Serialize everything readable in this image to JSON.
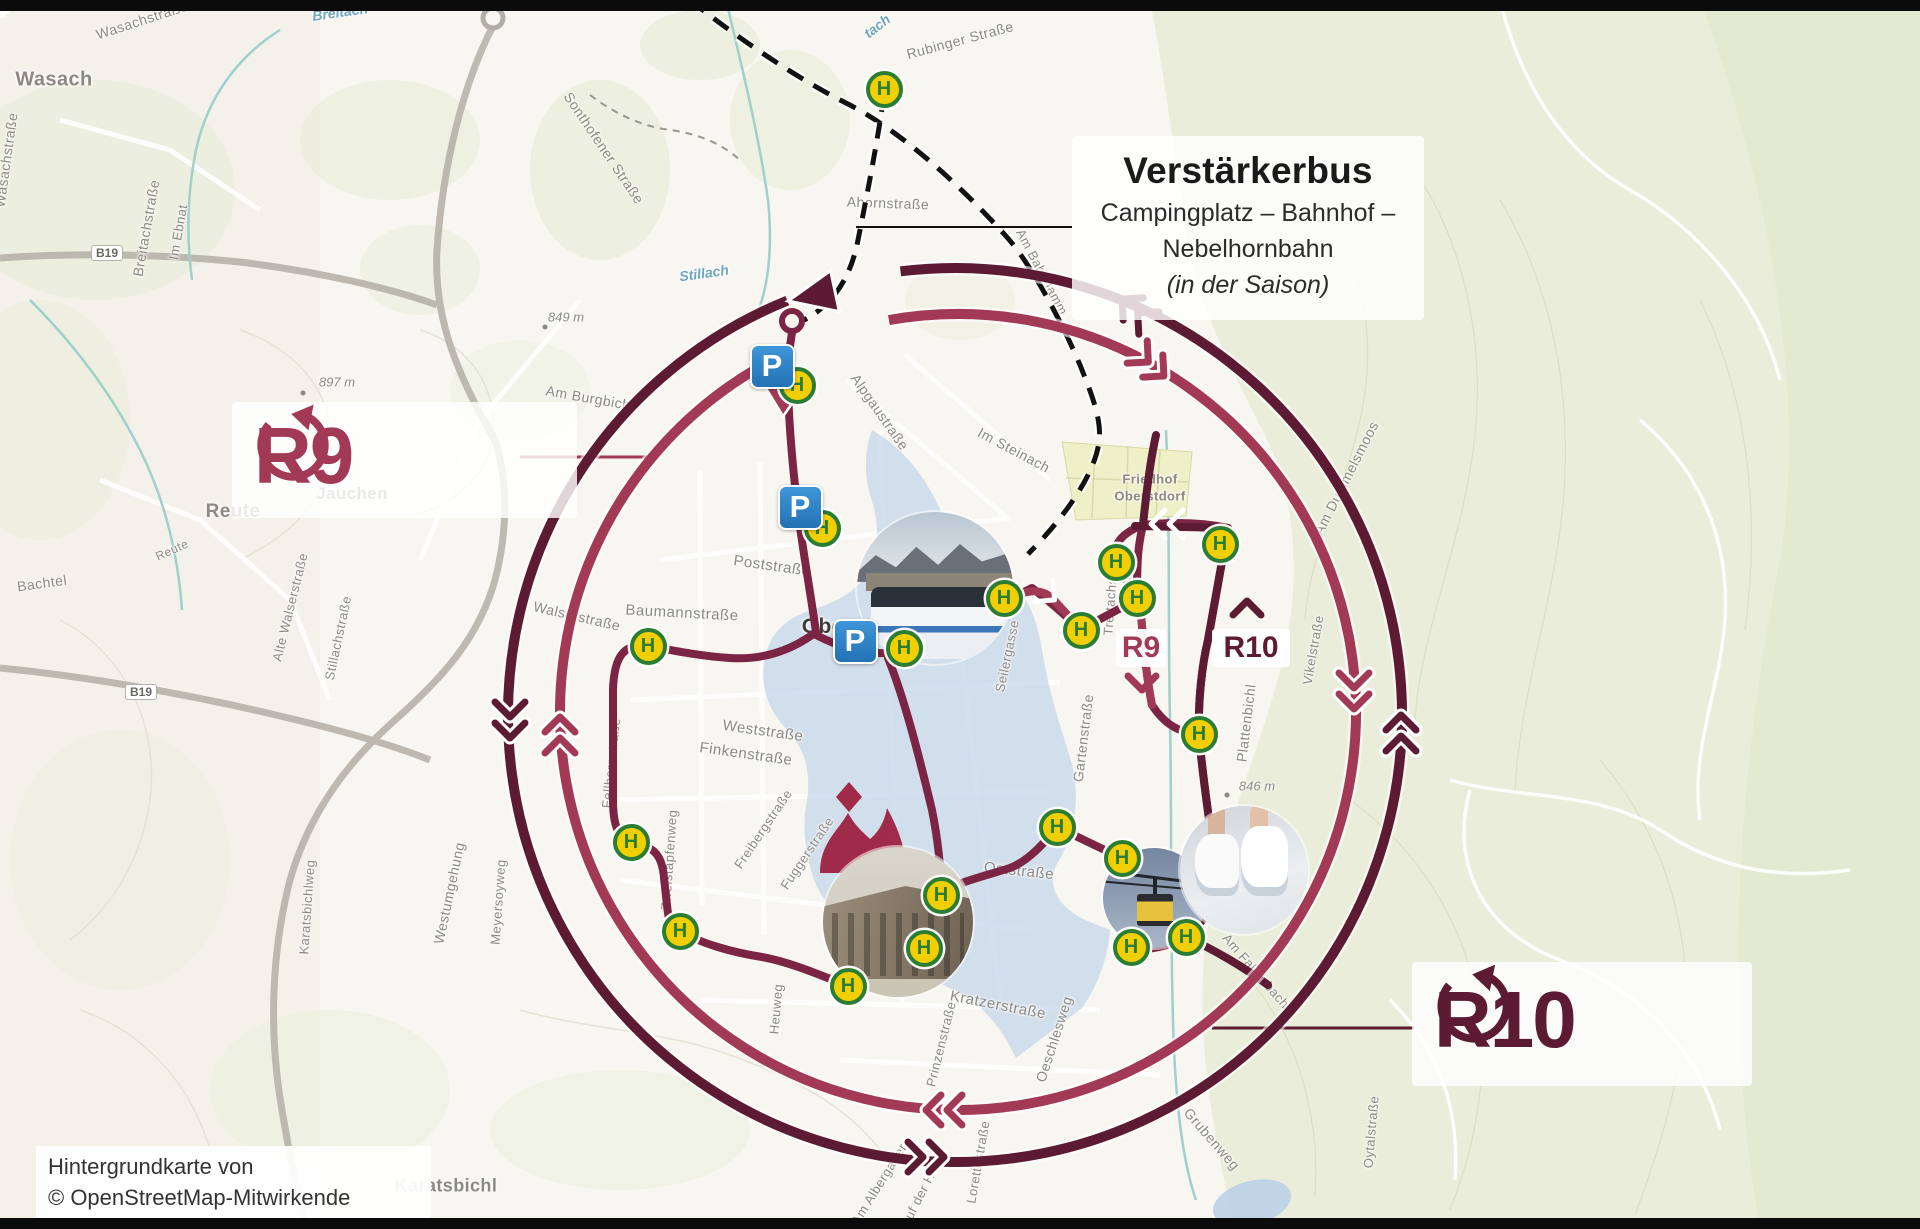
{
  "map": {
    "size": {
      "width": 1920,
      "height": 1229
    },
    "attribution": {
      "line1": "Hintergrundkarte von",
      "line2": "© OpenStreetMap-Mitwirkende"
    },
    "verstaerkerbus": {
      "title": "Verstärkerbus",
      "line1": "Campingplatz – Bahnhof –",
      "line2": "Nebelhornbahn",
      "line3": "(in der Saison)"
    },
    "route_labels": {
      "r9": "R9",
      "r10": "R10"
    },
    "inline_labels": {
      "r9": "R9",
      "r10": "R10"
    },
    "symbols": {
      "bus_stop": "H",
      "parking": "P"
    },
    "icons": {
      "r9_loop": "loop-arrow-counterclockwise",
      "r10_loop": "loop-arrow-counterclockwise"
    },
    "colors": {
      "r9": "#a23a56",
      "r10": "#5c1b33",
      "route": "#7b2444",
      "stopG": "#2a7d33",
      "stopY": "#f2cf00",
      "pblue": "#2f86c8",
      "water": "#b9cfe6",
      "forest": "#e9edda",
      "labelGray": "#8d8881",
      "ink": "#111111"
    },
    "road_badges": [
      {
        "t": "B19",
        "x": 107,
        "y": 253
      },
      {
        "t": "B19",
        "x": 141,
        "y": 692
      }
    ],
    "place_labels": [
      {
        "t": "Wasach",
        "x": 54,
        "y": 80,
        "s": 20
      },
      {
        "t": "Jauchen",
        "x": 352,
        "y": 494,
        "s": 17
      },
      {
        "t": "Reute",
        "x": 233,
        "y": 512,
        "s": 19
      },
      {
        "t": "Oberstdorf",
        "x": 858,
        "y": 627,
        "s": 21,
        "dark": true
      },
      {
        "t": "Friedhof",
        "x": 1150,
        "y": 479,
        "s": 13
      },
      {
        "t": "Oberstdorf",
        "x": 1150,
        "y": 496,
        "s": 13
      },
      {
        "t": "Karatsbichl",
        "x": 446,
        "y": 1186,
        "s": 18
      }
    ],
    "street_labels": [
      {
        "t": "Wasachstraße",
        "x": 142,
        "y": 20,
        "r": -18,
        "s": 14
      },
      {
        "t": "Wasachstraße",
        "x": 6,
        "y": 160,
        "r": -82,
        "s": 14
      },
      {
        "t": "Breitachstraße",
        "x": 146,
        "y": 228,
        "r": -80,
        "s": 14
      },
      {
        "t": "Im Ebnat",
        "x": 178,
        "y": 232,
        "r": -80,
        "s": 13
      },
      {
        "t": "Bachtel",
        "x": 42,
        "y": 583,
        "r": -8,
        "s": 14
      },
      {
        "t": "Sonthofener Straße",
        "x": 604,
        "y": 148,
        "r": 56,
        "s": 14
      },
      {
        "t": "Ahornstraße",
        "x": 888,
        "y": 203,
        "r": 2,
        "s": 14
      },
      {
        "t": "Rubinger Straße",
        "x": 960,
        "y": 40,
        "r": -15,
        "s": 14
      },
      {
        "t": "Am Bahndamm",
        "x": 1042,
        "y": 272,
        "r": 62,
        "s": 13
      },
      {
        "t": "Am Burgbichl",
        "x": 590,
        "y": 398,
        "r": 10,
        "s": 14
      },
      {
        "t": "Alpgaustraße",
        "x": 880,
        "y": 412,
        "r": 55,
        "s": 14
      },
      {
        "t": "Im Steinach",
        "x": 1014,
        "y": 450,
        "r": 28,
        "s": 14
      },
      {
        "t": "Am Dummelsmoos",
        "x": 1346,
        "y": 478,
        "r": -63,
        "s": 14
      },
      {
        "t": "Alte Walserstraße",
        "x": 290,
        "y": 607,
        "r": -76,
        "s": 13
      },
      {
        "t": "Stillachstraße",
        "x": 338,
        "y": 638,
        "r": -78,
        "s": 13
      },
      {
        "t": "Reute",
        "x": 172,
        "y": 550,
        "r": -24,
        "s": 12
      },
      {
        "t": "Walserstraße",
        "x": 577,
        "y": 616,
        "r": 13,
        "s": 14
      },
      {
        "t": "Baumannstraße",
        "x": 682,
        "y": 613,
        "r": 3,
        "s": 15
      },
      {
        "t": "Poststraße",
        "x": 772,
        "y": 566,
        "r": 8,
        "s": 15
      },
      {
        "t": "Weststraße",
        "x": 763,
        "y": 731,
        "r": 8,
        "s": 15
      },
      {
        "t": "Finkenstraße",
        "x": 746,
        "y": 754,
        "r": 8,
        "s": 15
      },
      {
        "t": "Fellhornstraße",
        "x": 611,
        "y": 763,
        "r": -84,
        "s": 13
      },
      {
        "t": "Freibergstraße",
        "x": 763,
        "y": 829,
        "r": -56,
        "s": 13
      },
      {
        "t": "Fuggerstraße",
        "x": 807,
        "y": 853,
        "r": -56,
        "s": 13
      },
      {
        "t": "Zweistapfenweg",
        "x": 669,
        "y": 860,
        "r": -86,
        "s": 13
      },
      {
        "t": "Westumgehung",
        "x": 449,
        "y": 893,
        "r": -78,
        "s": 14
      },
      {
        "t": "Meyersoyweg",
        "x": 498,
        "y": 902,
        "r": -86,
        "s": 13
      },
      {
        "t": "Karatsbichlweg",
        "x": 307,
        "y": 907,
        "r": -86,
        "s": 13
      },
      {
        "t": "Heuweg",
        "x": 776,
        "y": 1009,
        "r": -85,
        "s": 13
      },
      {
        "t": "Seilergasse",
        "x": 1007,
        "y": 656,
        "r": -78,
        "s": 13
      },
      {
        "t": "Trettachstraße",
        "x": 1111,
        "y": 590,
        "r": -86,
        "s": 13
      },
      {
        "t": "Gartenstraße",
        "x": 1083,
        "y": 738,
        "r": -83,
        "s": 14
      },
      {
        "t": "Plattenbichl",
        "x": 1246,
        "y": 723,
        "r": -83,
        "s": 14
      },
      {
        "t": "Vikelstraße",
        "x": 1313,
        "y": 650,
        "r": -80,
        "s": 13
      },
      {
        "t": "Oststraße",
        "x": 1019,
        "y": 871,
        "r": 6,
        "s": 15
      },
      {
        "t": "Kratzerstraße",
        "x": 998,
        "y": 1005,
        "r": 11,
        "s": 15
      },
      {
        "t": "Oeschlesweg",
        "x": 1054,
        "y": 1039,
        "r": -72,
        "s": 14
      },
      {
        "t": "Sachserweg",
        "x": 942,
        "y": 944,
        "r": -80,
        "s": 13
      },
      {
        "t": "Prinzenstraße",
        "x": 941,
        "y": 1044,
        "r": -76,
        "s": 13
      },
      {
        "t": "Lorettostraße",
        "x": 978,
        "y": 1162,
        "r": -80,
        "s": 13
      },
      {
        "t": "Am Albergatter",
        "x": 879,
        "y": 1184,
        "r": -58,
        "s": 13
      },
      {
        "t": "Auf der Höh",
        "x": 921,
        "y": 1193,
        "r": -63,
        "s": 13
      },
      {
        "t": "Grubenweg",
        "x": 1212,
        "y": 1139,
        "r": 49,
        "s": 14
      },
      {
        "t": "Oytalstraße",
        "x": 1371,
        "y": 1132,
        "r": -85,
        "s": 13
      },
      {
        "t": "Am Faltenbach",
        "x": 1256,
        "y": 971,
        "r": 49,
        "s": 13
      }
    ],
    "water_labels": [
      {
        "t": "Breitach",
        "x": 340,
        "y": 12,
        "r": -8
      },
      {
        "t": "tach",
        "x": 877,
        "y": 26,
        "r": -38
      },
      {
        "t": "Stillach",
        "x": 704,
        "y": 273,
        "r": -8
      }
    ],
    "elevation_labels": [
      {
        "t": "897 m",
        "x": 337,
        "y": 382
      },
      {
        "t": "849 m",
        "x": 566,
        "y": 317
      },
      {
        "t": "846 m",
        "x": 1257,
        "y": 786
      }
    ],
    "bus_stops": [
      {
        "x": 884,
        "y": 89
      },
      {
        "x": 797,
        "y": 385
      },
      {
        "x": 822,
        "y": 528
      },
      {
        "x": 648,
        "y": 646
      },
      {
        "x": 904,
        "y": 648
      },
      {
        "x": 1004,
        "y": 598
      },
      {
        "x": 1081,
        "y": 630
      },
      {
        "x": 1137,
        "y": 598
      },
      {
        "x": 1116,
        "y": 562
      },
      {
        "x": 1220,
        "y": 544
      },
      {
        "x": 1199,
        "y": 734
      },
      {
        "x": 1057,
        "y": 827
      },
      {
        "x": 1122,
        "y": 858
      },
      {
        "x": 631,
        "y": 842
      },
      {
        "x": 680,
        "y": 931
      },
      {
        "x": 848,
        "y": 986
      },
      {
        "x": 924,
        "y": 948
      },
      {
        "x": 941,
        "y": 895
      },
      {
        "x": 1131,
        "y": 947
      },
      {
        "x": 1186,
        "y": 937
      }
    ],
    "parkings": [
      {
        "x": 772,
        "y": 366
      },
      {
        "x": 800,
        "y": 507
      },
      {
        "x": 855,
        "y": 641
      }
    ]
  }
}
